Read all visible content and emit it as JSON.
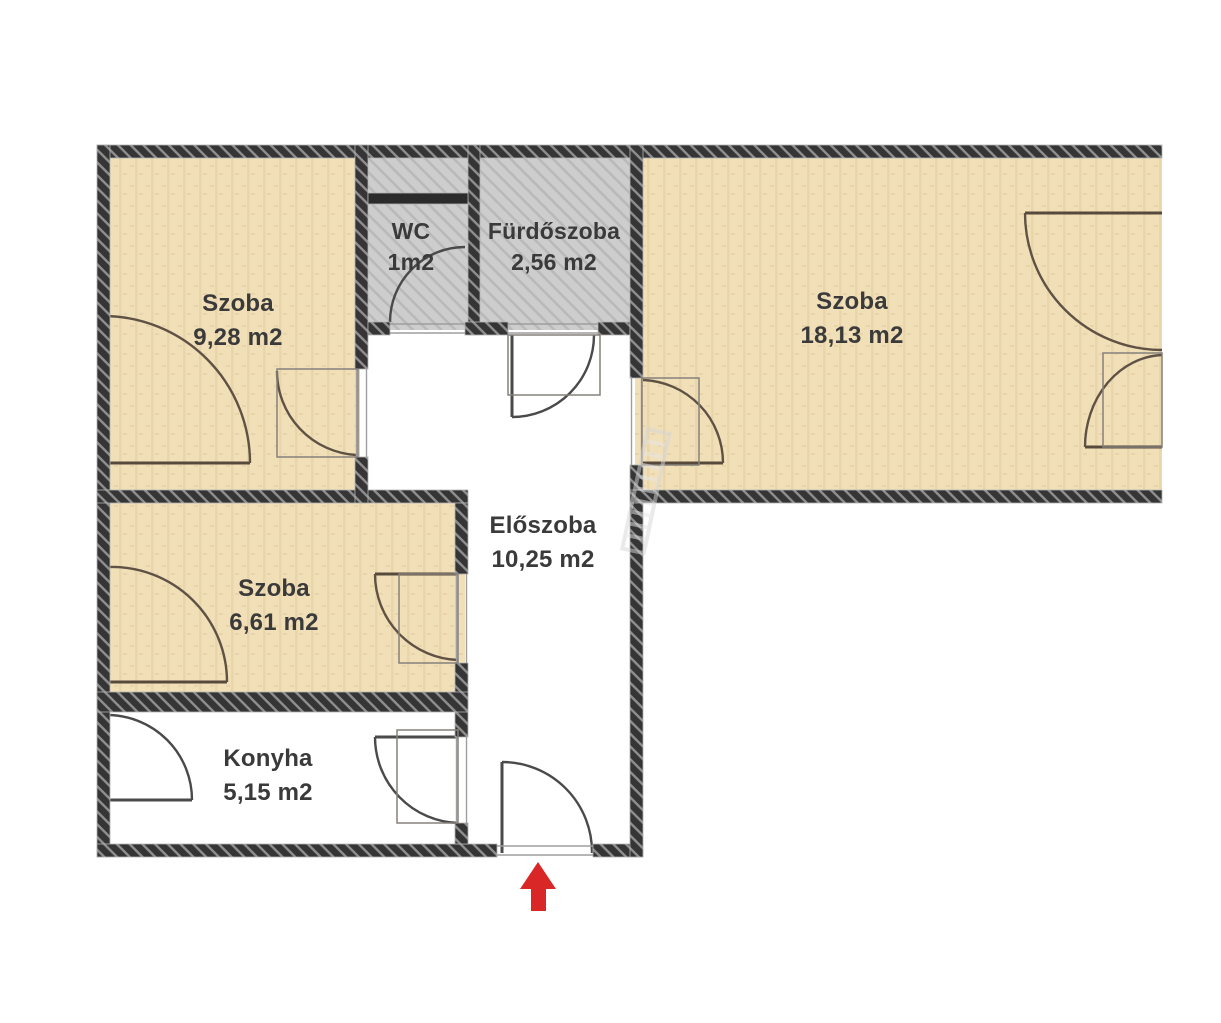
{
  "plan_type": "apartment-floor-plan",
  "rooms": [
    {
      "name": "Szoba",
      "area": "9,28 m2"
    },
    {
      "name": "WC",
      "area": "1m2"
    },
    {
      "name": "Fürdőszoba",
      "area": "2,56 m2"
    },
    {
      "name": "Szoba",
      "area": "18,13 m2"
    },
    {
      "name": "Előszoba",
      "area": "10,25 m2"
    },
    {
      "name": "Szoba",
      "area": "6,61 m2"
    },
    {
      "name": "Konyha",
      "area": "5,15 m2"
    }
  ],
  "icons": {
    "entrance_arrow": "red-up-arrow"
  },
  "colors": {
    "room_fill_tan": "#f1dfb8",
    "wet_room_fill_gray": "#cdcdcd",
    "wall_dark": "#353535",
    "door_line": "#5f5244",
    "entrance_arrow_red": "#d92626",
    "label_text": "#3a3a3a",
    "background": "#ffffff"
  }
}
